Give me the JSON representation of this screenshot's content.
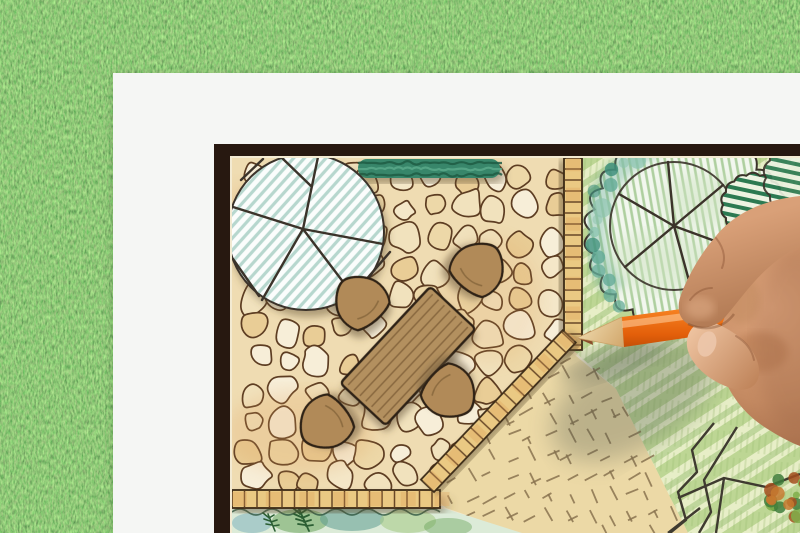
{
  "scene": {
    "subject": "hand drawing a garden landscape architecture plan with an orange colored pencil",
    "background": "artificial-grass-lawn",
    "objects": {
      "paper": "white-paper-sheet",
      "plan": "garden-plan-drawing-with-dark-frame",
      "patio": "flagstone-patio",
      "tree_left": "large-round-shade-tree-blue-hatched",
      "tree_right": "round-tree-with-spokes-and-shrub-cloud",
      "hedge": "green-hedge-band",
      "furniture": "wood-plank-table-with-four-fan-chairs",
      "edging": "brick-edging-strips",
      "lawn": "striped-green-lawn",
      "gravel": "tan-groundcover-with-dash-marks",
      "bed": "watercolor-planting-bed-with-ferns",
      "rocks": "rock-outline-paths-bottom-right",
      "hand": "right-hand-holding-pencil",
      "pencil": "orange-colored-pencil"
    }
  },
  "colors": {
    "grass_base": "#4a7c38",
    "paper": "#f5f6f4",
    "frame": "#271810",
    "plan_margin": "#f3ead2",
    "stone_grout": "#efdcb2",
    "stone_1": "#f7eed8",
    "stone_2": "#f1e2bd",
    "stone_3": "#edd8a8",
    "stone_4": "#f4e7c8",
    "stone_5": "#e9cd96",
    "stone_wash": "#dfa05c",
    "ink": "#52361e",
    "outline_dark": "#3b332a",
    "tree_fill": "#fbfdfc",
    "tree_hatch": "#b7d7ce",
    "hedge": "#37866a",
    "hedge_dark": "#1f5c44",
    "hedge_light": "#5aa98a",
    "brick": "#eac983",
    "brick_tick": "#5a3a1d",
    "brick_wash": "#dd9e55",
    "lawn_base": "#dde8b6",
    "lawn_light": "#e9efcb",
    "lawn_mid": "#b5d18b",
    "lawn_dark": "#8fba68",
    "cloud_fill": "#f2f7ee",
    "cloud_hatch": "#aecf9f",
    "teal_1": "#3f8f7c",
    "teal_2": "#63ab97",
    "teal_3": "#8cc4b0",
    "shrub_stripe": "#2c7a52",
    "shrub_bg": "#edf3e2",
    "tan_ground": "#ecd9a6",
    "tan_dash": "#8a7450",
    "bed_base": "#dcebd8",
    "bed_teal": "#5e9c92",
    "bed_green": "#5f9e4f",
    "bed_light": "#a9cc8b",
    "bed_blue": "#82b2bd",
    "fern": "#2b5e33",
    "wood_table": "#b3905e",
    "wood_line": "#7e5f38",
    "chair": "#b18a58",
    "rock_line": "#3f3b30",
    "dab_orange": "#c6792f",
    "dab_rust": "#a44f1f",
    "dab_green": "#3f7d3b",
    "dab_lime": "#7fae4a",
    "pencil_orange": "#f57f1f",
    "pencil_hi": "#ffb066",
    "pencil_lo": "#bf4e07",
    "pencil_wood": "#e7c894",
    "pencil_point": "#8a4f2c",
    "skin_hi": "#e9bd98",
    "skin_mid": "#c98e65",
    "skin_lo": "#a06b47",
    "skin_deep": "#7c4a2e",
    "shadow": "#4e564c"
  }
}
